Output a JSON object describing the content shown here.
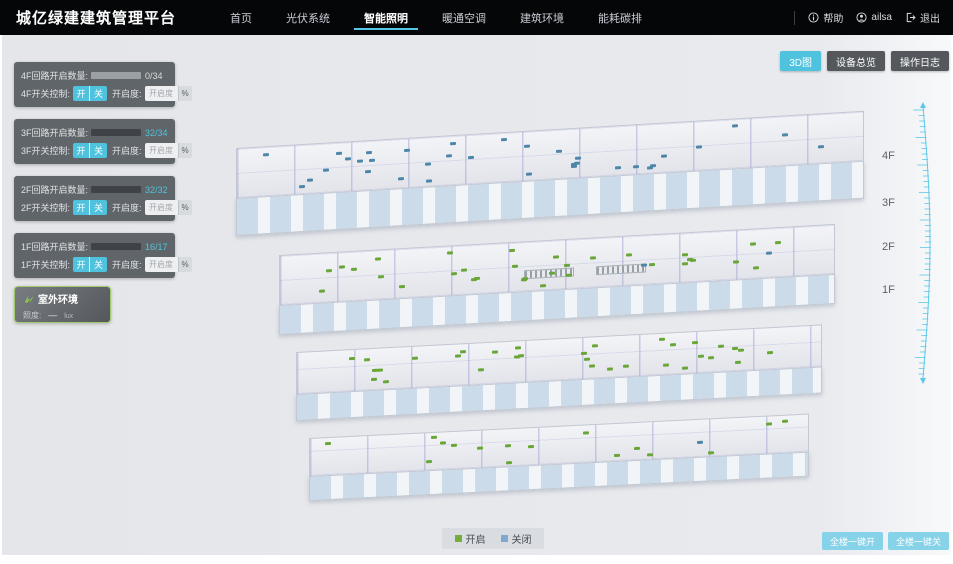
{
  "header": {
    "title": "城亿绿建建筑管理平台",
    "nav": [
      {
        "label": "首页",
        "active": false
      },
      {
        "label": "光伏系统",
        "active": false
      },
      {
        "label": "智能照明",
        "active": true
      },
      {
        "label": "暖通空调",
        "active": false
      },
      {
        "label": "建筑环境",
        "active": false
      },
      {
        "label": "能耗碳排",
        "active": false
      }
    ],
    "help": "帮助",
    "user": "ailsa",
    "logout": "退出"
  },
  "toolbar": {
    "buttons": [
      {
        "label": "3D图",
        "active": true
      },
      {
        "label": "设备总览",
        "active": false
      },
      {
        "label": "操作日志",
        "active": false
      }
    ]
  },
  "floor_panels": [
    {
      "count_label": "4F回路开启数量:",
      "value": "0/34",
      "on": 0,
      "total": 34,
      "switch_label": "4F开关控制:",
      "on_label": "开",
      "off_label": "关",
      "dim_label": "开启度:",
      "dim_placeholder": "开启度",
      "dim_unit": "%"
    },
    {
      "count_label": "3F回路开启数量:",
      "value": "32/34",
      "on": 32,
      "total": 34,
      "switch_label": "3F开关控制:",
      "on_label": "开",
      "off_label": "关",
      "dim_label": "开启度:",
      "dim_placeholder": "开启度",
      "dim_unit": "%"
    },
    {
      "count_label": "2F回路开启数量:",
      "value": "32/32",
      "on": 32,
      "total": 32,
      "switch_label": "2F开关控制:",
      "on_label": "开",
      "off_label": "关",
      "dim_label": "开启度:",
      "dim_placeholder": "开启度",
      "dim_unit": "%"
    },
    {
      "count_label": "1F回路开启数量:",
      "value": "16/17",
      "on": 16,
      "total": 17,
      "switch_label": "1F开关控制:",
      "on_label": "开",
      "off_label": "关",
      "dim_label": "开启度:",
      "dim_placeholder": "开启度",
      "dim_unit": "%"
    }
  ],
  "outdoor": {
    "title": "室外环境",
    "metric_label": "照度:",
    "metric_value": "—",
    "metric_unit": "lux"
  },
  "building": {
    "floor_labels": [
      "4F",
      "3F",
      "2F",
      "1F"
    ],
    "floors": [
      {
        "name": "4F",
        "lights_on": 0,
        "lights_off": 34
      },
      {
        "name": "3F",
        "lights_on": 32,
        "lights_off": 2
      },
      {
        "name": "2F",
        "lights_on": 32,
        "lights_off": 0
      },
      {
        "name": "1F",
        "lights_on": 16,
        "lights_off": 1
      }
    ]
  },
  "legend": [
    {
      "label": "开启",
      "color": "#74ad3e"
    },
    {
      "label": "关闭",
      "color": "#7fa9cf"
    }
  ],
  "bulk_actions": [
    {
      "label": "全楼一键开"
    },
    {
      "label": "全楼一键关"
    }
  ],
  "colors": {
    "accent": "#4fc3dd",
    "light_on": "#6aa637",
    "light_off": "#4d86a8",
    "value_dim": "#d9dcdf"
  }
}
